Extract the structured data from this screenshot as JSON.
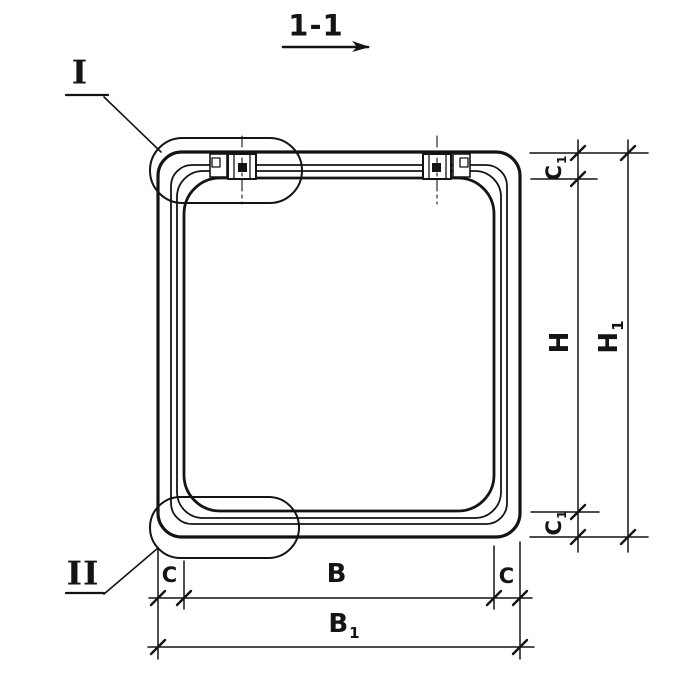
{
  "title": {
    "section_label": "1-1"
  },
  "details": {
    "callout_top": "I",
    "callout_bottom": "II"
  },
  "dims": {
    "b": {
      "base": "B",
      "sub": ""
    },
    "b1": {
      "base": "B",
      "sub": "1"
    },
    "c_left": {
      "base": "C",
      "sub": ""
    },
    "c_right": {
      "base": "C",
      "sub": ""
    },
    "c1_top": {
      "base": "C",
      "sub": "1"
    },
    "c1_bottom": {
      "base": "C",
      "sub": "1"
    },
    "h": {
      "base": "H",
      "sub": ""
    },
    "h1": {
      "base": "H",
      "sub": "1"
    }
  },
  "colors": {
    "ink": "#141414",
    "background": "#ffffff"
  }
}
